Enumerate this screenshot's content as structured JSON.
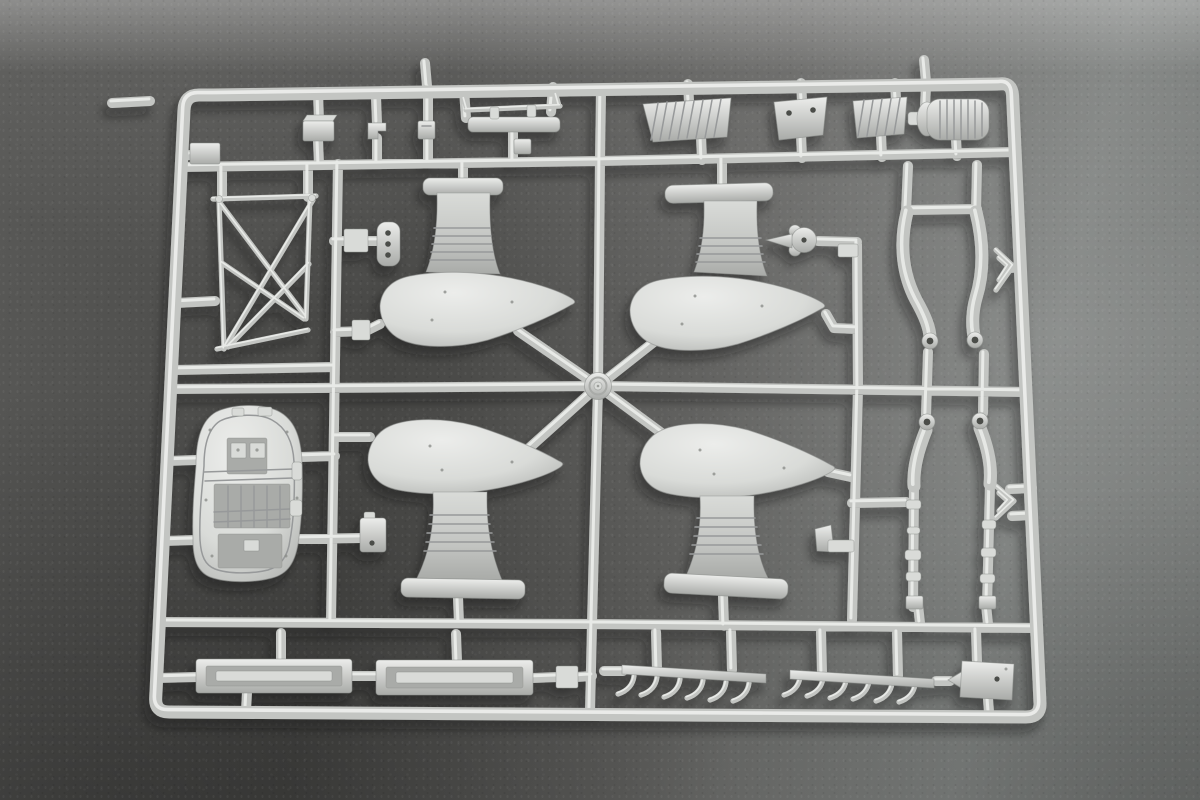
{
  "scene": {
    "kind": "photograph",
    "subject": "plastic-model-kit-sprue",
    "plastic_color_name": "light-gray",
    "background_name": "dark-gray-textured-surface"
  },
  "colors": {
    "bg-top": "#a2a2a0",
    "bg-right": "#7b7e7c",
    "bg-mid": "#5a5a58",
    "bg-dark": "#464644",
    "plastic-hi": "#ecedeb",
    "plastic-light": "#d9dbd8",
    "plastic-mid": "#c3c5c2",
    "plastic-deep": "#a9aba8",
    "plastic-dark": "#8b8d8a",
    "line-detail": "#97999a",
    "hole-dark": "#4c4e4a",
    "shadow": "#141414"
  },
  "parts": [
    "sprue-frame",
    "runner-network",
    "center-hub-boss",
    "injection-gate-nubs",
    "corner-box-part",
    "small-box-part",
    "small-bracket-part-1",
    "small-bracket-part-2",
    "hanging-handle-part",
    "louvered-panel-left",
    "access-plate-two-holes",
    "louvered-panel-right",
    "ribbed-drum-part",
    "x-braced-strut-frame",
    "three-hole-bracket",
    "cockpit-floor-tub",
    "wheel-spat-upper-left",
    "wheel-spat-upper-right",
    "wheel-spat-lower-left",
    "wheel-spat-lower-right",
    "scalloped-wheel-part",
    "small-box-lower-left",
    "small-flag-lower-right",
    "gear-blade-upper-left",
    "gear-blade-upper-right",
    "gear-blade-lower-left",
    "gear-blade-lower-right",
    "oleo-rod-left",
    "oleo-rod-right",
    "v-hook-bracket-upper",
    "v-hook-bracket-lower",
    "channel-part-1",
    "channel-part-2",
    "exhaust-stack-comb-1",
    "exhaust-stack-comb-2",
    "flat-plate-part"
  ]
}
